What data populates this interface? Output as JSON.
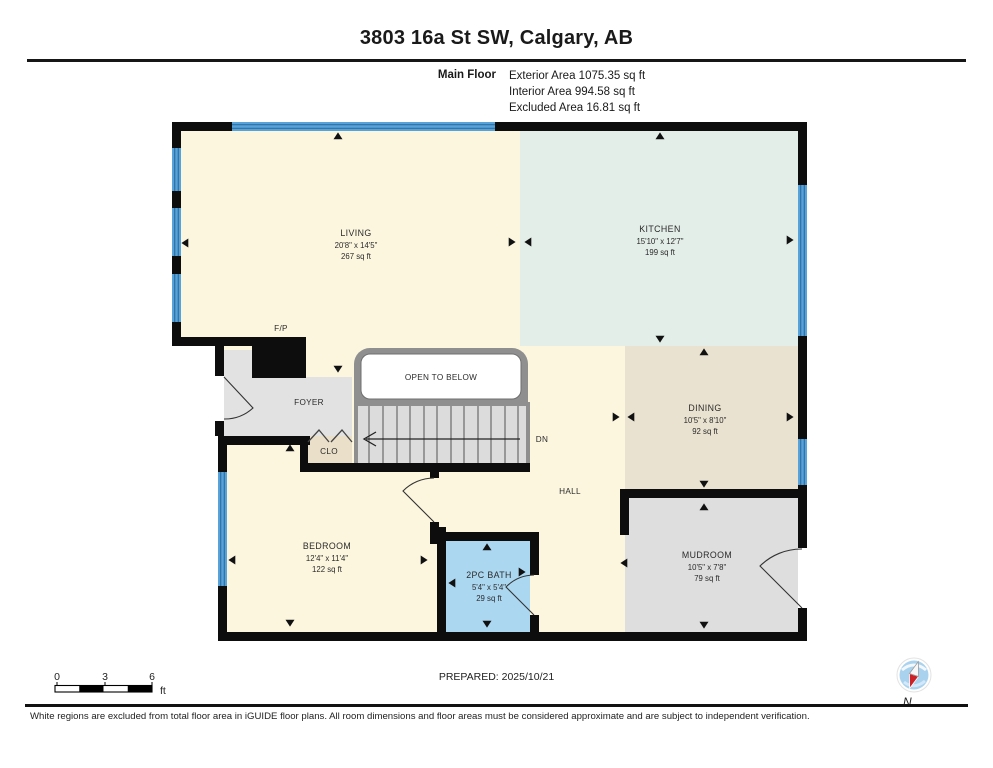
{
  "header": {
    "title": "3803 16a St SW, Calgary, AB",
    "floor_label": "Main Floor",
    "area_lines": [
      "Exterior Area 1075.35 sq ft",
      "Interior Area 994.58 sq ft",
      "Excluded Area 16.81 sq ft"
    ]
  },
  "plan": {
    "rooms": [
      {
        "name": "LIVING",
        "dims": "20'8\" x 14'5\"",
        "area": "267 sq ft"
      },
      {
        "name": "KITCHEN",
        "dims": "15'10\" x 12'7\"",
        "area": "199 sq ft"
      },
      {
        "name": "DINING",
        "dims": "10'5\" x 8'10\"",
        "area": "92 sq ft"
      },
      {
        "name": "MUDROOM",
        "dims": "10'5\" x 7'8\"",
        "area": "79 sq ft"
      },
      {
        "name": "BEDROOM",
        "dims": "12'4\" x 11'4\"",
        "area": "122 sq ft"
      },
      {
        "name": "2PC BATH",
        "dims": "5'4\" x 5'4\"",
        "area": "29 sq ft"
      }
    ],
    "labels": {
      "foyer": "FOYER",
      "closet": "CLO",
      "hall": "HALL",
      "open_to_below": "OPEN TO BELOW",
      "stairs_direction": "DN",
      "fireplace": "F/P"
    },
    "colors": {
      "room_cream": "#FCF6DF",
      "kitchen_mint": "#E3EEE8",
      "dining_tan": "#EAE2D0",
      "mudroom_gray": "#DEDEDE",
      "bath_blue": "#ABD7F1",
      "foyer_gray": "#E2E2E2",
      "closet_tan": "#EADFC9",
      "window_blue": "#57A3D9",
      "wall_black": "#0D0D0D"
    }
  },
  "scale_bar": {
    "ticks": [
      "0",
      "3",
      "6"
    ],
    "unit": "ft"
  },
  "footer": {
    "prepared": "PREPARED: 2025/10/21",
    "compass_label": "N",
    "disclaimer": "White regions are excluded from total floor area in iGUIDE floor plans. All room dimensions and floor areas must be considered approximate and are subject to independent verification."
  }
}
